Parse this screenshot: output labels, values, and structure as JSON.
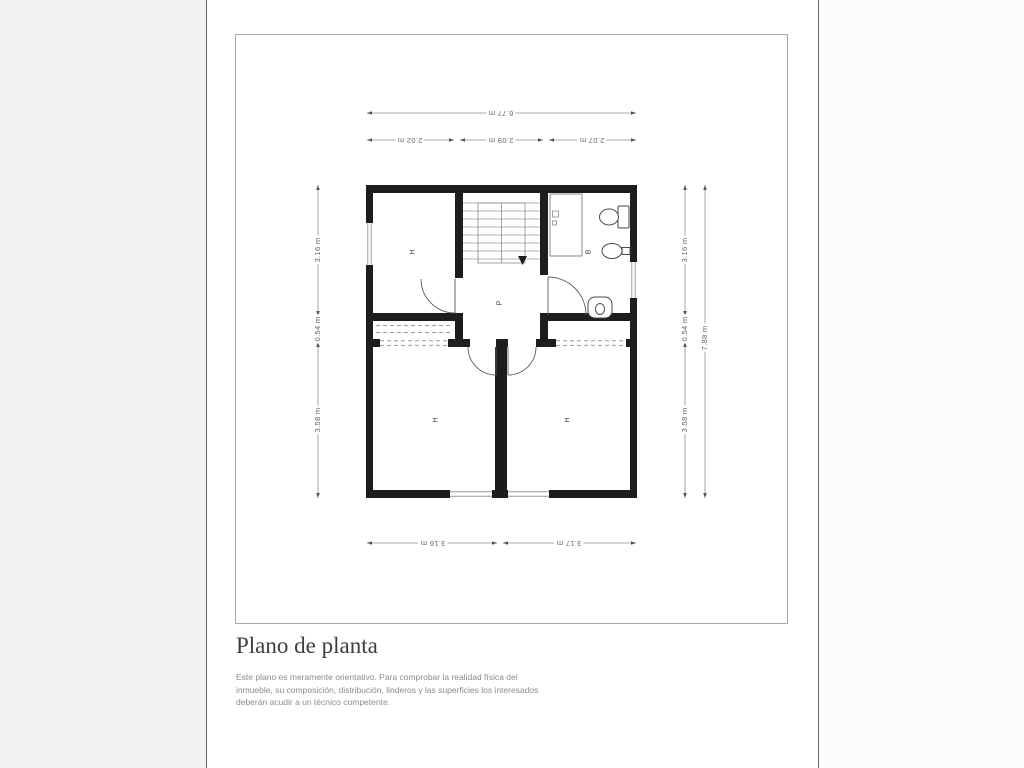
{
  "page": {
    "title": "Plano de planta",
    "disclaimer_lines": [
      "Este plano es meramente orientativo. Para comprobar la realidad física del",
      "inmueble, su composición, distribución, linderos y las superficies los interesados",
      "deberán acudir a un técnico competente."
    ]
  },
  "plan": {
    "dims": {
      "top_total": "6.77 m",
      "top": [
        "2.02 m",
        "2.09 m",
        "2.07 m"
      ],
      "left": [
        "3.16 m",
        "0.54 m",
        "3.58 m"
      ],
      "right": [
        "3.16 m",
        "0.54 m",
        "3.58 m"
      ],
      "right_total": "7.88 m",
      "bottom": [
        "3.16 m",
        "3.17 m"
      ]
    },
    "labels": {
      "room_top_left": "H",
      "bathroom": "B",
      "hallway": "P",
      "room_bottom_left": "H",
      "room_bottom_right": "H"
    }
  },
  "colors": {
    "wall": "#1d1d1b",
    "dim_text": "#666666",
    "dim_line": "#8f8f8f",
    "title": "#3e3d39",
    "disclaimer": "#8b8b89",
    "frame_border": "#a9a9a7",
    "page_margin": "#f3f2f0"
  }
}
